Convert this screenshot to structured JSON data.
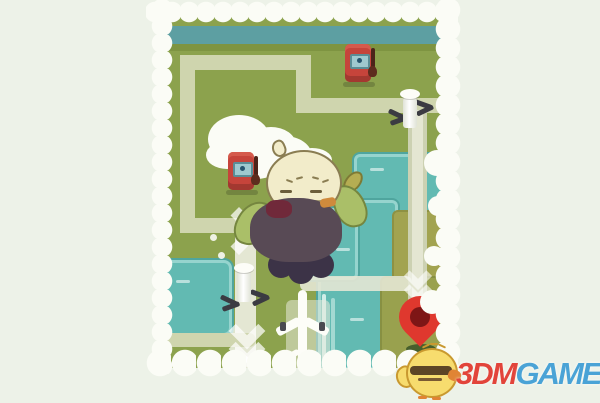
{
  "scene": {
    "description": "cartoon travel game world map with roads, river, gas stations, windmills, airplane and destination pin; chick character in center",
    "markers": [
      {
        "name": "gas-pump",
        "position": "top-right"
      },
      {
        "name": "gas-pump",
        "position": "mid-left"
      },
      {
        "name": "windmill",
        "position": "right-road"
      },
      {
        "name": "windmill",
        "position": "bottom-left-road"
      },
      {
        "name": "airplane",
        "position": "bottom-center"
      },
      {
        "name": "destination-pin",
        "position": "bottom-right"
      },
      {
        "name": "chick-character",
        "position": "center"
      }
    ],
    "direction_arrows": [
      "right-double-chevron-center",
      "down-chevrons-bottom-left",
      "down-chevrons-near-pin"
    ]
  },
  "watermark": {
    "brand_red": "3DM",
    "brand_blue": "GAME",
    "mascot": "chick-mascot"
  },
  "colors": {
    "page_background": "#edf2e8",
    "grass": "#8ca24d",
    "grass_dark": "#7e9441",
    "road": "#cfd5ae",
    "road_light": "#e9ebdc",
    "water": "#62bab2",
    "water_strip": "#5d9fa2",
    "olive_land": "#a2a350",
    "cloud_white": "#fbfcf6",
    "pump_red": "#c6443b",
    "pin_red": "#df382e",
    "pin_inner": "#7e1616",
    "character_head": "#f2ecca",
    "character_body": "#584a55",
    "wing_green": "#aabf68",
    "logo_red": "#e2443a",
    "logo_blue": "#4aa3d6",
    "chick_yellow": "#f7dc6e"
  }
}
